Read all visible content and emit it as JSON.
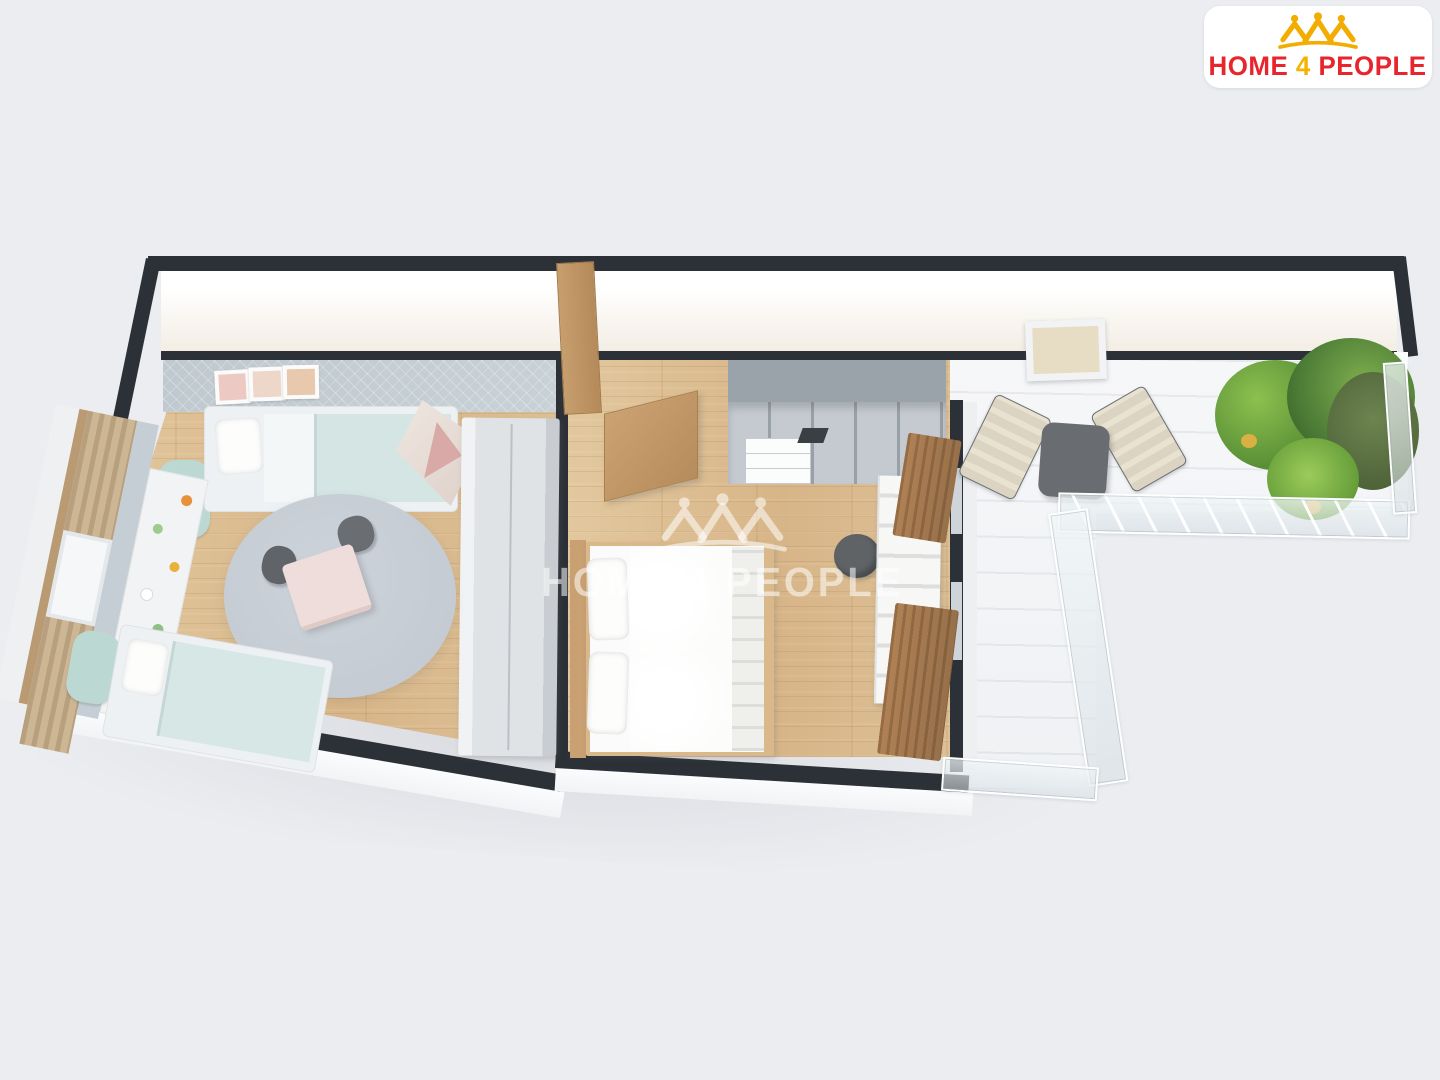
{
  "meta": {
    "image_type": "3d-apartment-floor-plan-render",
    "background_color": "#ECEDF1",
    "wall_color": "#2B3137",
    "wood_floor_color": "#DCBE93",
    "balcony_floor_color": "#F4F5F7"
  },
  "brand": {
    "logo_full": "HOME 4 PEOPLE",
    "logo_text_parts": [
      {
        "text": "HOME",
        "color": "#E8252C"
      },
      {
        "text": "4",
        "color": "#F5B301"
      },
      {
        "text": "PEOPLE",
        "color": "#E8252C"
      }
    ],
    "crown_icon": "three-house-people-crown-icon",
    "crown_icon_color": "#F2AD00",
    "card_color": "#FFFFFF"
  },
  "watermark": {
    "text": "HOME 4 PEOPLE",
    "icon": "three-house-people-crown-icon",
    "color": "rgba(255,255,255,0.55)"
  },
  "floor_plan": {
    "view": "top-down 3D cutaway, long horizontal apartment, lit white wall faces along top",
    "rooms": [
      {
        "name": "children-room",
        "position": "left",
        "floor": "light-oak-wood",
        "wall_accent": "light blue-gray textured wall",
        "furniture": [
          "single-bed-top",
          "single-bed-bottom",
          "cloud-headboards",
          "round-gray-rug",
          "pink-kids-table",
          "two-dark-gray-kids-chairs",
          "teepee-play-tent",
          "tall-gray-wardrobe",
          "toy-shelf-bench",
          "window-with-beige-curtains",
          "three-wall-picture-frames"
        ]
      },
      {
        "name": "hallway",
        "position": "top-middle",
        "floor": "light-oak-wood",
        "furniture": [
          "open-entry-door",
          "wooden-cabinet-panel",
          "gray-open-shelving-unit",
          "white-drawer-unit"
        ]
      },
      {
        "name": "bedroom",
        "position": "middle",
        "floor": "light-oak-wood",
        "furniture": [
          "double-bed-white",
          "wood-bed-frame",
          "two-pillows",
          "folded-blankets",
          "carved-white-desk",
          "dark-gray-pouf",
          "brown-curtain-panels",
          "window-wall-to-balcony"
        ]
      },
      {
        "name": "balcony-terrace",
        "position": "right, L-shaped",
        "floor": "white-decking",
        "furniture": [
          "cream-lounge-chair-left",
          "cream-lounge-chair-right",
          "dark-gray-coffee-table",
          "potted-green-plants",
          "terracotta-pot",
          "yellow-pots",
          "glass-railing-l-shape",
          "skylight-window-on-wall"
        ]
      }
    ],
    "palette": {
      "rug": "#C9CFD6",
      "kids_bed_blanket": "#D4E5E4",
      "cloud_headboard": "#BCD8D3",
      "pink_table": "#EEDDDA",
      "wardrobe": "#DFE2E5",
      "shelving": "#C3C9CE",
      "plant_green": "#6FA83C",
      "glass": "#E4ECEF",
      "cream_chair": "#E9E2D0",
      "brown_curtain": "#A87C50",
      "pouf": "#5F6366"
    }
  }
}
